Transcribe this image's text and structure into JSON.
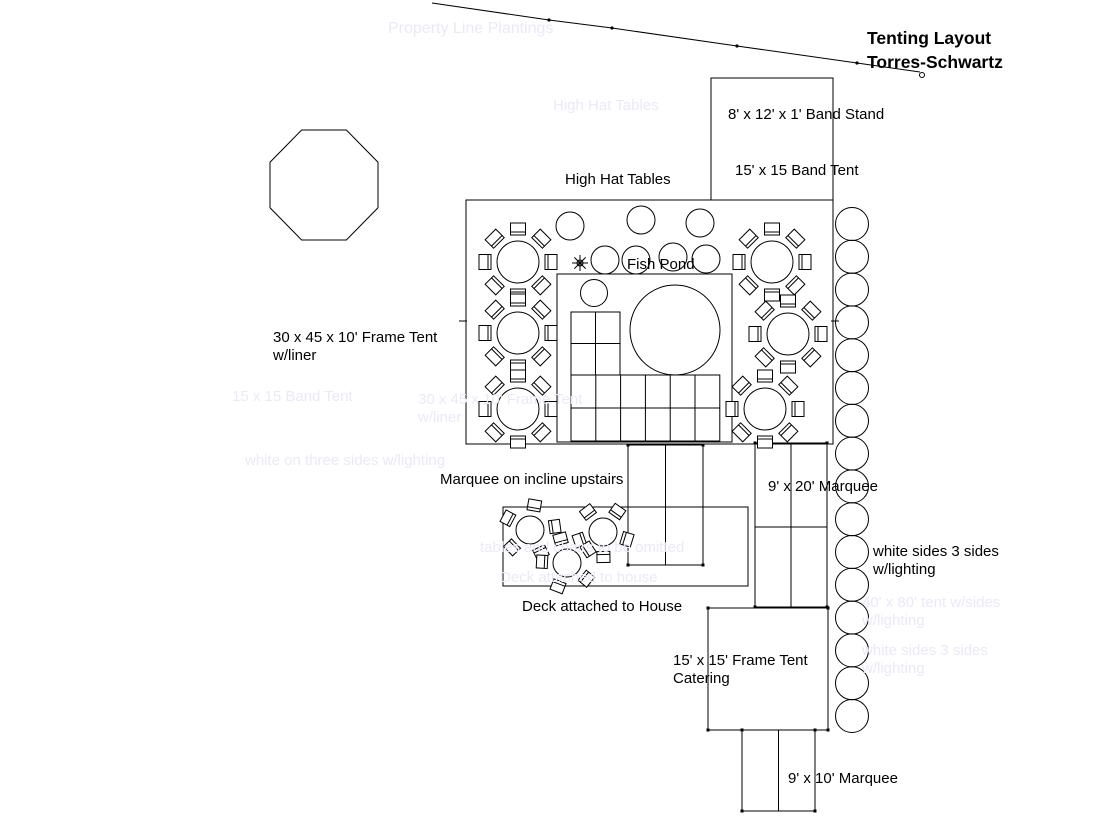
{
  "title": {
    "line1": "Tenting Layout",
    "line2": "Torres-Schwartz"
  },
  "ink_color": "#000000",
  "ghost_color": "#ebe9f5",
  "labels": [
    {
      "name": "band-stand-label",
      "text": "8' x 12' x 1' Band Stand",
      "x": 728,
      "y": 106
    },
    {
      "name": "band-tent-label",
      "text": "15' x 15 Band Tent",
      "x": 735,
      "y": 162
    },
    {
      "name": "high-hat-tables-label",
      "text": "High Hat Tables",
      "x": 565,
      "y": 171
    },
    {
      "name": "fish-pond-label",
      "text": "Fish Pond",
      "x": 627,
      "y": 256
    },
    {
      "name": "frame-tent-label-1",
      "text": "30 x 45 x 10' Frame Tent",
      "x": 273,
      "y": 329
    },
    {
      "name": "frame-tent-label-2",
      "text": "w/liner",
      "x": 273,
      "y": 347
    },
    {
      "name": "incline-marquee-label",
      "text": "Marquee on incline upstairs",
      "x": 440,
      "y": 471
    },
    {
      "name": "marquee-9x20-label",
      "text": "9' x 20' Marquee",
      "x": 768,
      "y": 478
    },
    {
      "name": "white-sides-label-1",
      "text": "white sides 3 sides",
      "x": 873,
      "y": 543
    },
    {
      "name": "white-sides-label-2",
      "text": "w/lighting",
      "x": 873,
      "y": 561
    },
    {
      "name": "deck-label",
      "text": "Deck attached to House",
      "x": 522,
      "y": 598
    },
    {
      "name": "catering-label-1",
      "text": "15' x 15' Frame Tent",
      "x": 673,
      "y": 652
    },
    {
      "name": "catering-label-2",
      "text": "Catering",
      "x": 673,
      "y": 670
    },
    {
      "name": "marquee-9x10-label",
      "text": "9' x 10' Marquee",
      "x": 788,
      "y": 770
    }
  ],
  "ghost_labels": [
    {
      "name": "ghost-property-line",
      "text": "Property Line Plantings",
      "x": 388,
      "y": 20,
      "size": 16
    },
    {
      "name": "ghost-high-hat",
      "text": "High Hat Tables",
      "x": 553,
      "y": 97,
      "size": 15
    },
    {
      "name": "ghost-band-tent",
      "text": "15 x 15 Band Tent",
      "x": 232,
      "y": 388,
      "size": 15
    },
    {
      "name": "ghost-frame-tent-1",
      "text": "30 x 45 x 10' Frame Tent",
      "x": 418,
      "y": 391,
      "size": 15
    },
    {
      "name": "ghost-frame-tent-2",
      "text": "w/liner",
      "x": 418,
      "y": 409,
      "size": 15
    },
    {
      "name": "ghost-white-3-sides",
      "text": "white on three sides w/lighting",
      "x": 245,
      "y": 452,
      "size": 15
    },
    {
      "name": "ghost-deck-1",
      "text": "tables and chairs to be omitted",
      "x": 480,
      "y": 539,
      "size": 15
    },
    {
      "name": "ghost-deck-2",
      "text": "Deck attached to house",
      "x": 500,
      "y": 569,
      "size": 15
    },
    {
      "name": "ghost-right-1a",
      "text": "40' x 80' tent w/sides",
      "x": 862,
      "y": 594,
      "size": 15
    },
    {
      "name": "ghost-right-1b",
      "text": "w/lighting",
      "x": 862,
      "y": 612,
      "size": 15
    },
    {
      "name": "ghost-right-2a",
      "text": "white sides 3 sides",
      "x": 862,
      "y": 642,
      "size": 15
    },
    {
      "name": "ghost-right-2b",
      "text": "w/lighting",
      "x": 862,
      "y": 660,
      "size": 15
    }
  ],
  "plan": {
    "property_line": {
      "points": [
        [
          432,
          3
        ],
        [
          549,
          20
        ],
        [
          612,
          28
        ],
        [
          737,
          46
        ],
        [
          857,
          63
        ],
        [
          920,
          72
        ]
      ]
    },
    "octagon": {
      "x": 270,
      "y": 130,
      "w": 108,
      "h": 110
    },
    "rects": [
      {
        "name": "band-tent-outline",
        "x": 711,
        "y": 78,
        "w": 122,
        "h": 122
      },
      {
        "name": "main-frame-tent-outline",
        "x": 466,
        "y": 200,
        "w": 367,
        "h": 244
      },
      {
        "name": "fish-pond-enclosure",
        "x": 557,
        "y": 274,
        "w": 175,
        "h": 168
      },
      {
        "name": "deck-outline",
        "x": 503,
        "y": 507,
        "w": 245,
        "h": 79
      }
    ],
    "marquees": [
      {
        "name": "incline-marquee",
        "x": 628,
        "y": 445,
        "w": 75,
        "h": 120,
        "vline": true,
        "hline": null,
        "dots": true
      },
      {
        "name": "marquee-9x20",
        "x": 755,
        "y": 443,
        "w": 72,
        "h": 164,
        "vline": true,
        "hline": 527,
        "dots": true
      },
      {
        "name": "catering-tent",
        "x": 708,
        "y": 608,
        "w": 120,
        "h": 122,
        "vline": false,
        "hline": null,
        "dots": true
      },
      {
        "name": "marquee-9x10",
        "x": 742,
        "y": 730,
        "w": 73,
        "h": 81,
        "vline": true,
        "hline": null,
        "dots": true
      }
    ],
    "grids": [
      {
        "name": "dance-floor-upper",
        "x": 571,
        "y": 312,
        "cols": 2,
        "rows": 2,
        "cw": 24.5,
        "rh": 31.5
      },
      {
        "name": "dance-floor-lower",
        "x": 571,
        "y": 375,
        "cols": 6,
        "rows": 2,
        "cw": 24.8,
        "rh": 33
      }
    ],
    "pond_circle": {
      "cx": 675,
      "cy": 330,
      "r": 45
    },
    "pond_octagon": {
      "cx": 594,
      "cy": 293,
      "r": 13.5
    },
    "high_hats": {
      "r": 14,
      "centers": [
        [
          570,
          226
        ],
        [
          641,
          220
        ],
        [
          700,
          223
        ],
        [
          605,
          260
        ],
        [
          636,
          260
        ],
        [
          673,
          257
        ],
        [
          706,
          259
        ]
      ]
    },
    "star": {
      "cx": 580,
      "cy": 263,
      "r": 8
    },
    "round_tables": {
      "r": 21,
      "chairs": 8,
      "chair_w": 15,
      "chair_h": 12,
      "chair_dist": 33,
      "centers": [
        [
          518,
          262
        ],
        [
          518,
          333
        ],
        [
          518,
          409
        ],
        [
          772,
          262
        ],
        [
          788,
          334
        ],
        [
          765,
          409
        ]
      ]
    },
    "deck_tables": {
      "r": 14,
      "chairs": 5,
      "chair_w": 13,
      "chair_h": 11,
      "chair_dist": 25,
      "items": [
        {
          "cx": 530,
          "cy": 530,
          "rot": 10
        },
        {
          "cx": 603,
          "cy": 532,
          "rot": 35
        },
        {
          "cx": 567,
          "cy": 563,
          "rot": -15
        }
      ]
    },
    "trees": {
      "cx": 852,
      "start_cy": 224,
      "spacing": 32.8,
      "count": 16,
      "r": 16.5
    },
    "ticks": [
      [
        459,
        321,
        467,
        321
      ],
      [
        831,
        321,
        839,
        321
      ]
    ]
  }
}
